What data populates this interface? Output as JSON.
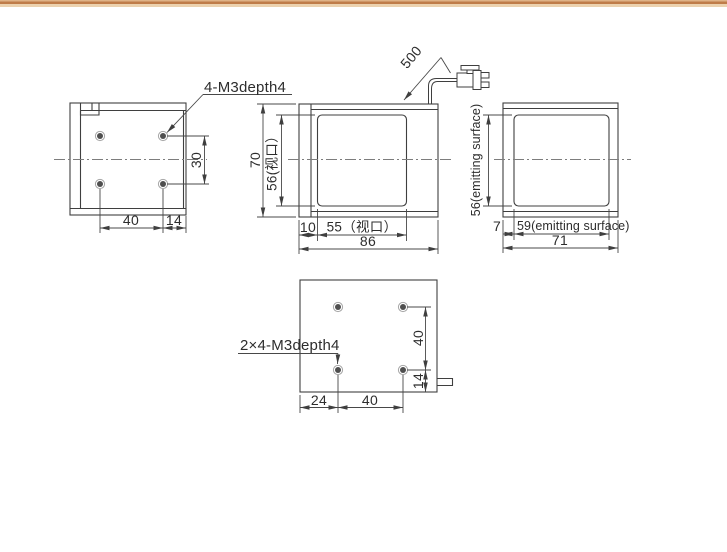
{
  "page": {
    "background": "#ffffff",
    "top_border_accent": "#bf7c49",
    "line_color": "#3f3f3f"
  },
  "drawing": {
    "notes": {
      "back_holes": "4-M3depth4",
      "bottom_holes": "2×4-M3depth4"
    },
    "back_view": {
      "dim_hole_spacing_v": "30",
      "dim_hole_spacing_h": "40",
      "dim_edge_offset": "14"
    },
    "side_view": {
      "dim_height": "70",
      "dim_window_height": "56(视口）",
      "dim_offset": "10",
      "dim_window_width": "55（视口）",
      "dim_width": "86",
      "dim_cable_length": "500"
    },
    "front_view": {
      "dim_emitting_height": "56(emitting surface)",
      "dim_offset": "7",
      "dim_emitting_width": "59(emitting surface)",
      "dim_width": "71"
    },
    "bottom_view": {
      "dim_hole_spacing_v": "40",
      "dim_edge_offset_v": "14",
      "dim_edge_offset_h": "24",
      "dim_hole_spacing_h": "40"
    }
  }
}
